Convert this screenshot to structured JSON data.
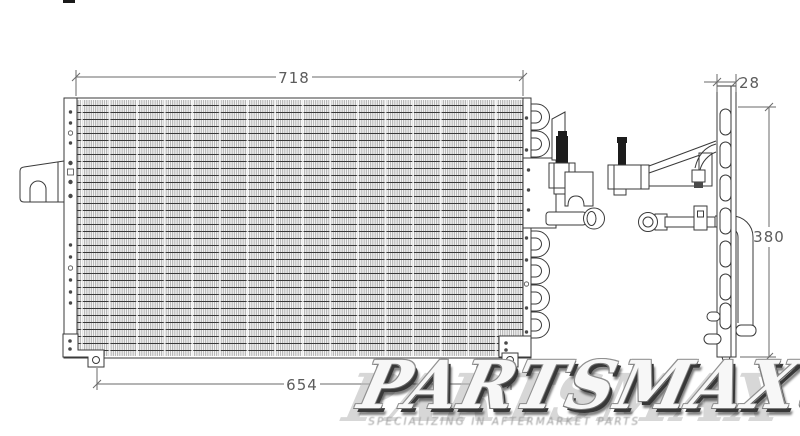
{
  "title": "AC condenser technical line drawing",
  "dimensions": {
    "core_width": "718",
    "bracket_depth": "28",
    "core_height": "380",
    "mount_span": "654"
  },
  "watermark": {
    "brand": "PARTSMAX",
    "registered": "®",
    "tagline": "SPECIALIZING IN AFTERMARKET PARTS"
  },
  "colors": {
    "background": "#ffffff",
    "line": "#3a3a3a",
    "dimension_text": "#5c5c5c",
    "watermark_shadow": "#383838"
  }
}
